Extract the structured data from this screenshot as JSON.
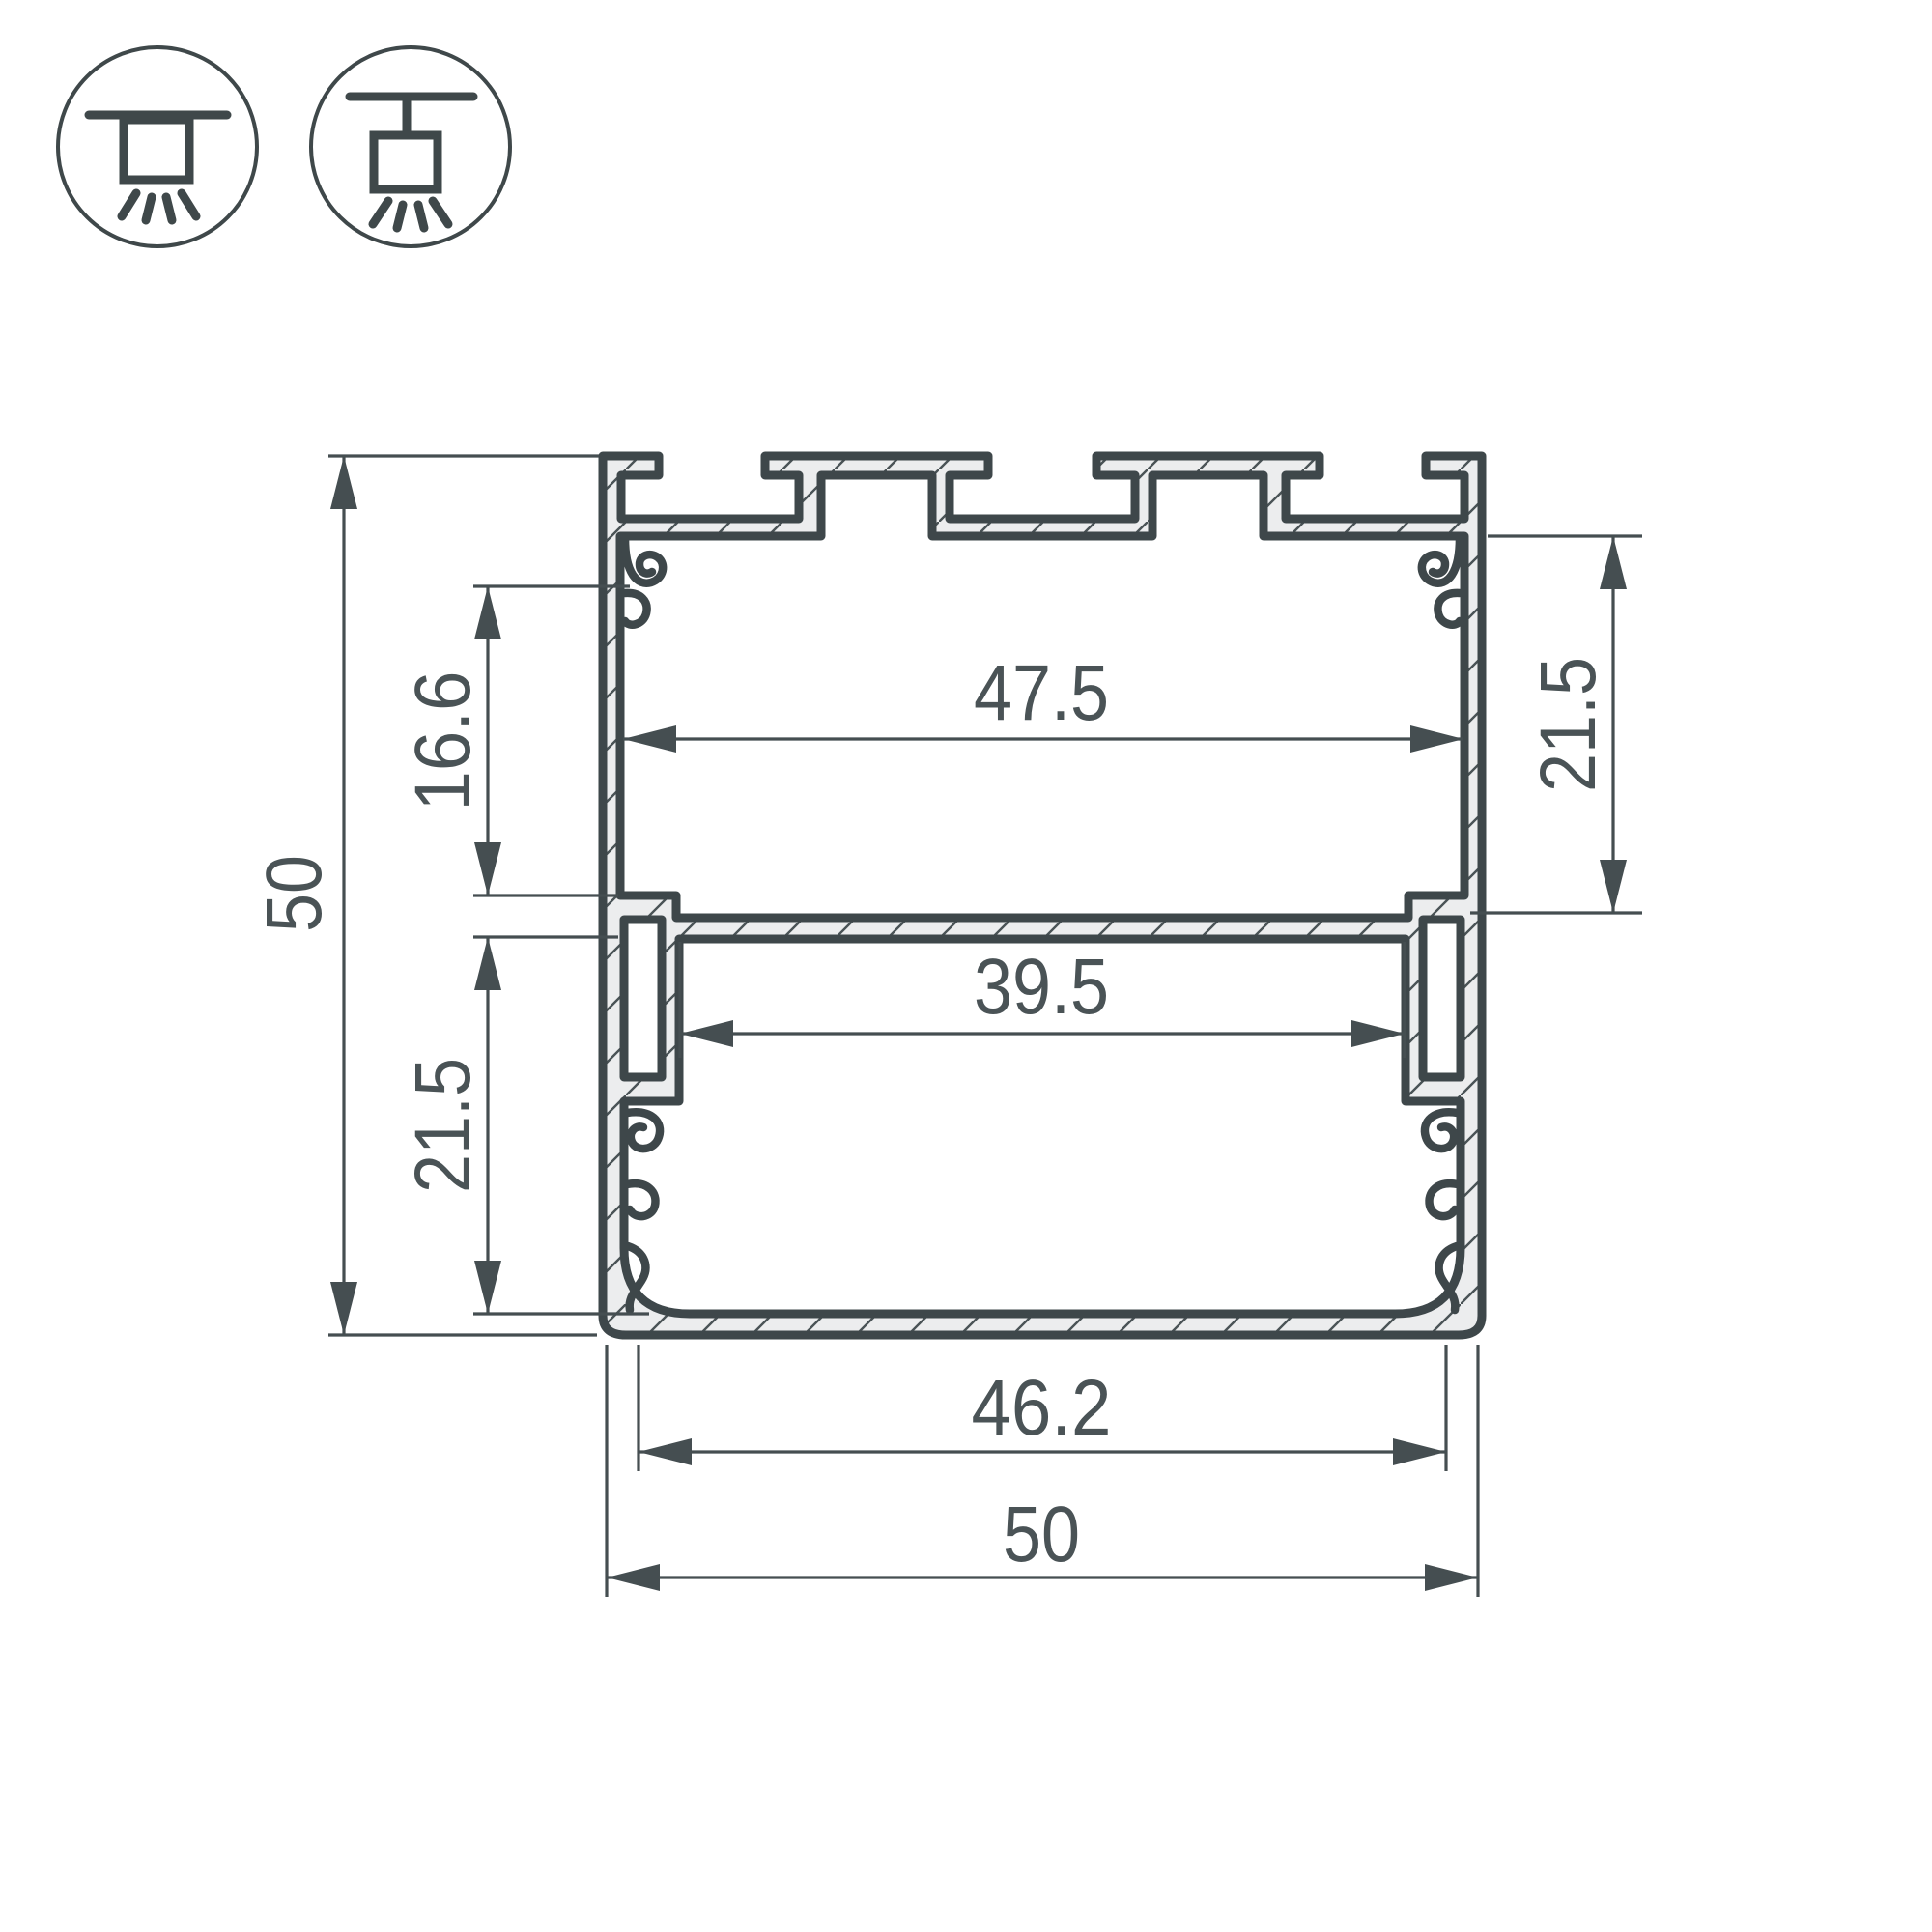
{
  "drawing": {
    "title": "LED profile cross-section 50x50",
    "dimensions": {
      "overall_height": "50",
      "overall_width": "50",
      "inner_width_top": "47.5",
      "inner_width_middle": "39.5",
      "inner_width_bottom": "46.2",
      "top_cavity_depth": "16.6",
      "right_cavity_depth": "21.5",
      "lower_cavity_depth": "21.5"
    },
    "icons": [
      {
        "name": "surface-mount-icon",
        "meaning": "surface ceiling mount luminaire"
      },
      {
        "name": "suspended-mount-icon",
        "meaning": "suspended pendant mount luminaire"
      }
    ],
    "colors": {
      "line": "#3e474a",
      "thin_line": "#454e51",
      "text": "#4a5356",
      "metal_fill": "#ecedee",
      "background": "#ffffff"
    }
  }
}
